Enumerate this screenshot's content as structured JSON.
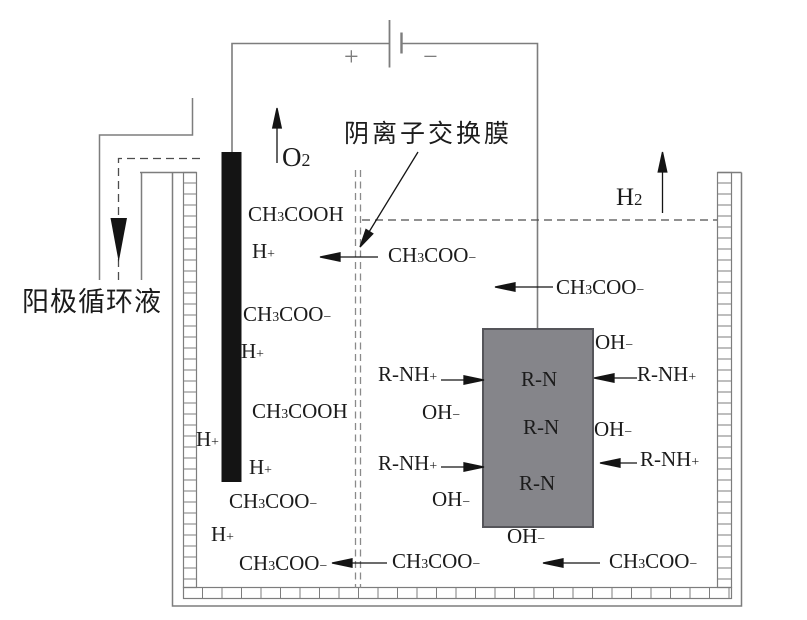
{
  "diagram": {
    "title_context": "electrolysis-cell-diagram",
    "colors": {
      "background": "#ffffff",
      "wire_gray": "#7d7d7d",
      "dark_line": "#1b1b1b",
      "electrode_black": "#141414",
      "resin_block_fill": "#85858a",
      "resin_block_border": "#55555a",
      "dashed_dark": "#4d4d4d",
      "membrane_gray": "#8a8a8a"
    },
    "text": {
      "membrane_label": "阴离子交换膜",
      "anolyte_label": "阳极循环液"
    },
    "battery": {
      "plus": "+",
      "minus": "−"
    },
    "chem_labels": [
      {
        "name": "o2-gas-label",
        "x": 282,
        "y": 143,
        "size": 27,
        "parts": [
          [
            "t",
            "O"
          ],
          [
            "sub",
            "2"
          ]
        ]
      },
      {
        "name": "h2-gas-label",
        "x": 616,
        "y": 185,
        "size": 25,
        "parts": [
          [
            "t",
            "H"
          ],
          [
            "sub",
            "2"
          ]
        ]
      },
      {
        "name": "anode-ch3cooh-1",
        "x": 248,
        "y": 203,
        "parts": [
          [
            "t",
            "CH"
          ],
          [
            "sub",
            "3"
          ],
          [
            "t",
            "COOH"
          ]
        ]
      },
      {
        "name": "anode-h-plus-1",
        "x": 252,
        "y": 240,
        "parts": [
          [
            "t",
            "H"
          ],
          [
            "sup",
            "+"
          ]
        ]
      },
      {
        "name": "anode-ch3coo-1",
        "x": 243,
        "y": 303,
        "parts": [
          [
            "t",
            "CH"
          ],
          [
            "sub",
            "3"
          ],
          [
            "t",
            "COO"
          ],
          [
            "sup",
            "−"
          ]
        ]
      },
      {
        "name": "anode-h-plus-2",
        "x": 241,
        "y": 340,
        "parts": [
          [
            "t",
            "H"
          ],
          [
            "sup",
            "+"
          ]
        ]
      },
      {
        "name": "anode-ch3cooh-2",
        "x": 252,
        "y": 400,
        "parts": [
          [
            "t",
            "CH"
          ],
          [
            "sub",
            "3"
          ],
          [
            "t",
            "COOH"
          ]
        ]
      },
      {
        "name": "anode-h-plus-wall",
        "x": 196,
        "y": 428,
        "parts": [
          [
            "t",
            "H"
          ],
          [
            "sup",
            "+"
          ]
        ]
      },
      {
        "name": "anode-h-plus-3",
        "x": 249,
        "y": 456,
        "parts": [
          [
            "t",
            "H"
          ],
          [
            "sup",
            "+"
          ]
        ]
      },
      {
        "name": "anode-ch3coo-2",
        "x": 229,
        "y": 490,
        "parts": [
          [
            "t",
            "CH"
          ],
          [
            "sub",
            "3"
          ],
          [
            "t",
            "COO"
          ],
          [
            "sup",
            "−"
          ]
        ]
      },
      {
        "name": "anode-h-plus-4",
        "x": 211,
        "y": 523,
        "parts": [
          [
            "t",
            "H"
          ],
          [
            "sup",
            "+"
          ]
        ]
      },
      {
        "name": "anode-ch3coo-3",
        "x": 239,
        "y": 552,
        "parts": [
          [
            "t",
            "CH"
          ],
          [
            "sub",
            "3"
          ],
          [
            "t",
            "COO"
          ],
          [
            "sup",
            "−"
          ]
        ]
      },
      {
        "name": "membrane-ch3coo",
        "x": 388,
        "y": 244,
        "parts": [
          [
            "t",
            "CH"
          ],
          [
            "sub",
            "3"
          ],
          [
            "t",
            "COO"
          ],
          [
            "sup",
            "−"
          ]
        ]
      },
      {
        "name": "cathode-ch3coo-mid",
        "x": 556,
        "y": 276,
        "parts": [
          [
            "t",
            "CH"
          ],
          [
            "sub",
            "3"
          ],
          [
            "t",
            "COO"
          ],
          [
            "sup",
            "−"
          ]
        ]
      },
      {
        "name": "bottom-ch3coo-mid",
        "x": 392,
        "y": 550,
        "parts": [
          [
            "t",
            "CH"
          ],
          [
            "sub",
            "3"
          ],
          [
            "t",
            "COO"
          ],
          [
            "sup",
            "−"
          ]
        ]
      },
      {
        "name": "bottom-ch3coo-right",
        "x": 609,
        "y": 550,
        "parts": [
          [
            "t",
            "CH"
          ],
          [
            "sub",
            "3"
          ],
          [
            "t",
            "COO"
          ],
          [
            "sup",
            "−"
          ]
        ]
      },
      {
        "name": "oh-top-right",
        "x": 595,
        "y": 331,
        "parts": [
          [
            "t",
            "OH"
          ],
          [
            "sup",
            "−"
          ]
        ]
      },
      {
        "name": "rnh-right-1",
        "x": 637,
        "y": 363,
        "parts": [
          [
            "t",
            "R-NH"
          ],
          [
            "sup",
            "+"
          ]
        ]
      },
      {
        "name": "oh-right-mid",
        "x": 594,
        "y": 418,
        "parts": [
          [
            "t",
            "OH"
          ],
          [
            "sup",
            "−"
          ]
        ]
      },
      {
        "name": "rnh-right-2",
        "x": 640,
        "y": 448,
        "parts": [
          [
            "t",
            "R-NH"
          ],
          [
            "sup",
            "+"
          ]
        ]
      },
      {
        "name": "rn-1",
        "x": 521,
        "y": 368,
        "parts": [
          [
            "t",
            "R-N"
          ]
        ]
      },
      {
        "name": "rn-2",
        "x": 523,
        "y": 416,
        "parts": [
          [
            "t",
            "R-N"
          ]
        ]
      },
      {
        "name": "rn-3",
        "x": 519,
        "y": 472,
        "parts": [
          [
            "t",
            "R-N"
          ]
        ]
      },
      {
        "name": "oh-bottom",
        "x": 507,
        "y": 525,
        "parts": [
          [
            "t",
            "OH"
          ],
          [
            "sup",
            "−"
          ]
        ]
      },
      {
        "name": "rnh-left-1",
        "x": 378,
        "y": 363,
        "parts": [
          [
            "t",
            "R-NH"
          ],
          [
            "sup",
            "+"
          ]
        ]
      },
      {
        "name": "oh-left-mid",
        "x": 422,
        "y": 401,
        "parts": [
          [
            "t",
            "OH"
          ],
          [
            "sup",
            "−"
          ]
        ]
      },
      {
        "name": "rnh-left-2",
        "x": 378,
        "y": 452,
        "parts": [
          [
            "t",
            "R-NH"
          ],
          [
            "sup",
            "+"
          ]
        ]
      },
      {
        "name": "oh-left-low",
        "x": 432,
        "y": 488,
        "parts": [
          [
            "t",
            "OH"
          ],
          [
            "sup",
            "−"
          ]
        ]
      }
    ]
  }
}
